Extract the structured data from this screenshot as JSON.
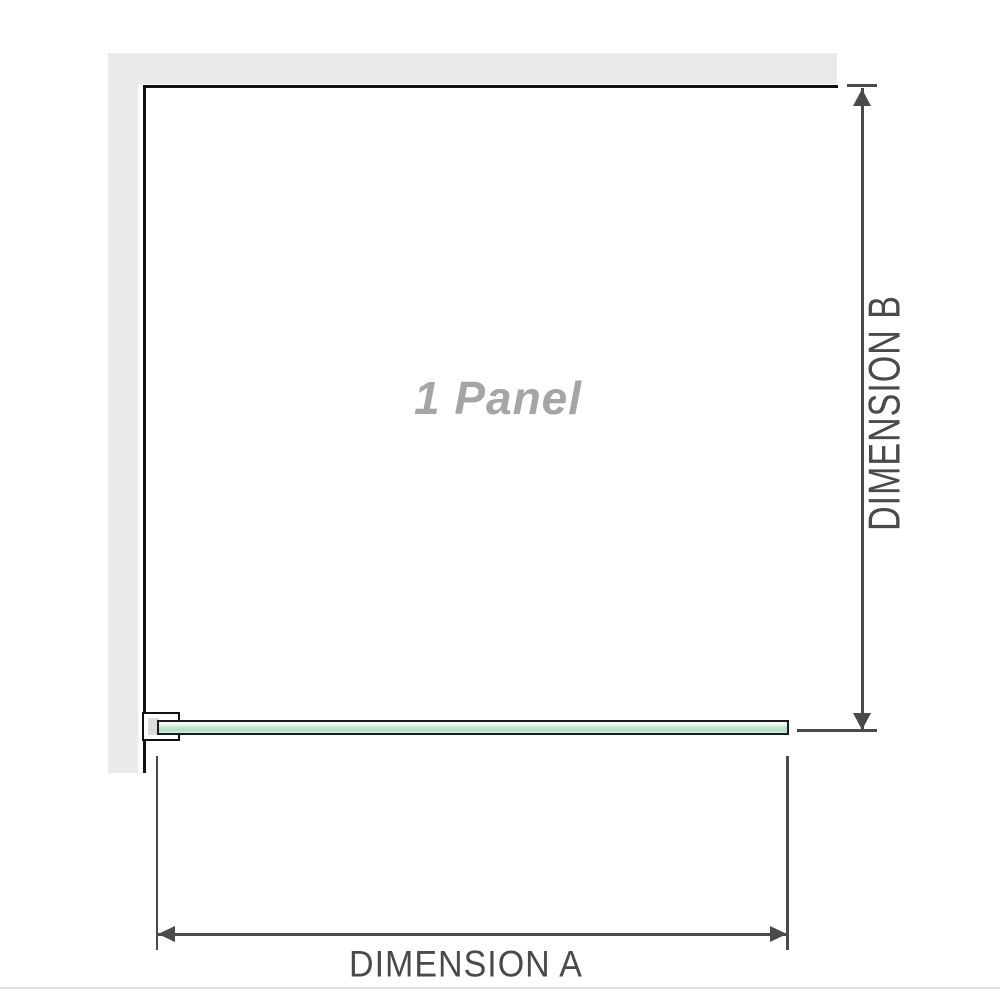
{
  "diagram": {
    "panel_label": "1 Panel",
    "dimension_a_label": "DIMENSION A",
    "dimension_b_label": "DIMENSION B"
  },
  "colors": {
    "wall_fill": "#eaeaea",
    "wall_edge": "#111111",
    "glass_fill": "#bce3cb",
    "glass_light": "#eef8f2",
    "glass_border": "#1c1c1c",
    "bracket_fill": "#ffffff",
    "bracket_insert": "#dcdcdc",
    "dimension_line": "#4a4a4a",
    "panel_label_color": "#a5a5a5",
    "dimension_label_color": "#4a4a4a",
    "background": "#ffffff",
    "footer_line": "#e2e2e2"
  }
}
